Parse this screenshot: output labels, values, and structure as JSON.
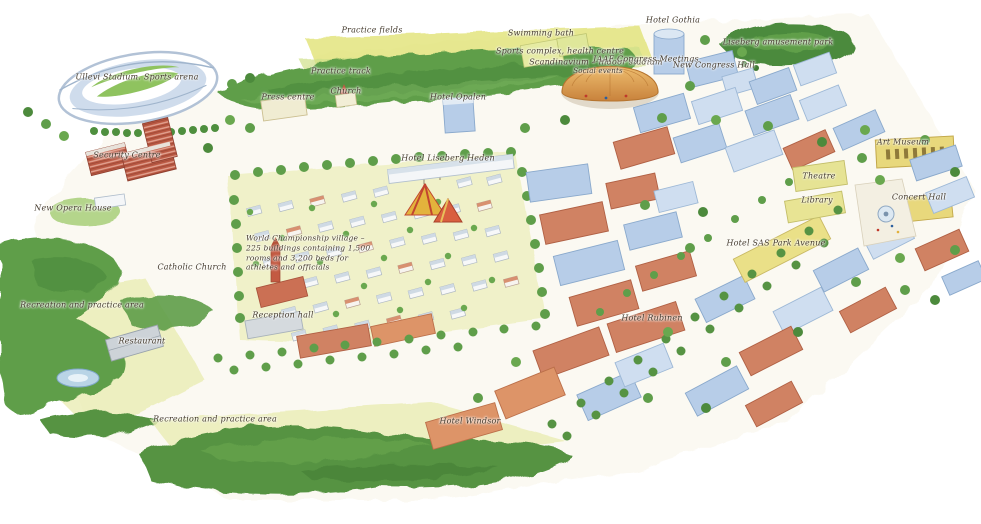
{
  "map": {
    "labels": [
      {
        "id": "practice-fields",
        "text": "Practice fields"
      },
      {
        "id": "hotel-gothia",
        "text": "Hotel Gothia"
      },
      {
        "id": "liseberg-amusement-park",
        "text": "Liseberg amusement park"
      },
      {
        "id": "swimming-bath",
        "text": "Swimming bath"
      },
      {
        "id": "sports-complex-health-centre",
        "text": "Sports complex, health centre"
      },
      {
        "id": "scandinavium",
        "text": "Scandinavium – indoor stadium"
      },
      {
        "id": "social-events",
        "text": "Social events"
      },
      {
        "id": "iaaf-congress-meetings",
        "text": "IAAF Congress Meetings"
      },
      {
        "id": "new-congress-hall",
        "text": "New Congress Hall"
      },
      {
        "id": "ullevi-stadium",
        "text": "Ullevi Stadium. Sports arena"
      },
      {
        "id": "practice-track",
        "text": "Practice track"
      },
      {
        "id": "press-centre",
        "text": "Press centre"
      },
      {
        "id": "church",
        "text": "Church"
      },
      {
        "id": "hotel-opalen",
        "text": "Hotel Opalen"
      },
      {
        "id": "art-museum",
        "text": "Art Museum"
      },
      {
        "id": "security-centre",
        "text": "Security Centre"
      },
      {
        "id": "hotel-liseberg-heden",
        "text": "Hotel Liseberg Heden"
      },
      {
        "id": "theatre",
        "text": "Theatre"
      },
      {
        "id": "new-opera-house",
        "text": "New Opera House"
      },
      {
        "id": "library",
        "text": "Library"
      },
      {
        "id": "concert-hall",
        "text": "Concert Hall"
      },
      {
        "id": "hotel-sas-park-avenue",
        "text": "Hotel SAS Park Avenue"
      },
      {
        "id": "village-note",
        "text": "World Championship village – 225 buildings containing 1,500 rooms and 3,200 beds for athletes and officials"
      },
      {
        "id": "catholic-church",
        "text": "Catholic Church"
      },
      {
        "id": "recreation-west",
        "text": "Recreation and practice area"
      },
      {
        "id": "reception-hall",
        "text": "Reception hall"
      },
      {
        "id": "hotel-rubinen",
        "text": "Hotel Rubinen"
      },
      {
        "id": "restaurant",
        "text": "Restaurant"
      },
      {
        "id": "recreation-south",
        "text": "Recreation and practice area"
      },
      {
        "id": "hotel-windsor",
        "text": "Hotel Windsor"
      }
    ],
    "colors": {
      "tree_green": "#5f9e4a",
      "tree_dark": "#4c8a3c",
      "tree_light": "#7ab45e",
      "field_yellow": "#e3e57e",
      "building_blue": "#b7cde8",
      "building_blue_pale": "#cfdef0",
      "roof_red": "#d08263",
      "roof_orange": "#dd9468",
      "building_yellow": "#eae088",
      "brick_red": "#bb5a44",
      "dome_orange": "#d99a4c",
      "water_blue": "#b9d4e6",
      "ink": "#463c2f"
    }
  }
}
